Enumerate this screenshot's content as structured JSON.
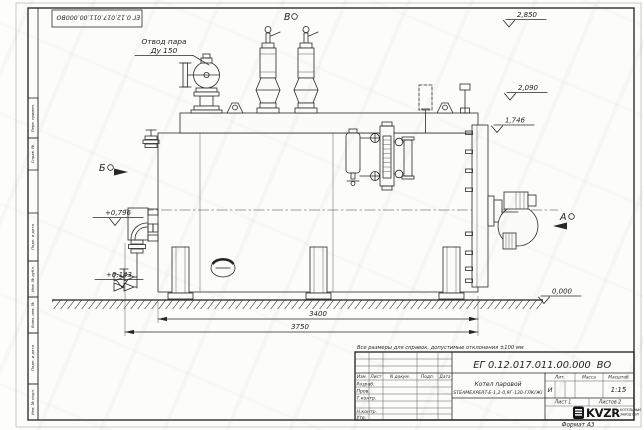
{
  "sheet": {
    "note": "Все размеры для справок, допустимые отклонения ±100 мм",
    "designation_number": "ЕГ 0.12.017.011.00.000",
    "designation_suffix": "ВО",
    "format_label": "Формат А3"
  },
  "side_stamps": [
    "Перв. примен.",
    "Справ. №",
    "Подп. и дата",
    "Инв. № дубл.",
    "Взам. инв. №",
    "Подп. и дата",
    "Инв. № подл."
  ],
  "title_block": {
    "columns": [
      "Изм.",
      "Лист",
      "N докум.",
      "Подп.",
      "Дата"
    ],
    "row_developed": "Разраб.",
    "row_checked": "Пров.",
    "row_tcontrol": "Т.контр.",
    "row_ncontrol": "Н.контр.",
    "row_approved": "Утв.",
    "product_title": "Котел паровой",
    "product_model": "STEAMEXPERT-Е-1,2-0,9Г-130-ГЛК(Ж)",
    "lit_label": "Лит.",
    "lit_value": "И",
    "mass_label": "Масса",
    "scale_label": "Масштаб",
    "scale_value": "1:15",
    "sheet_text": "Лист 1",
    "sheets_text": "Листов 2",
    "logo_text": "KVZR",
    "logo_sub1": "КОТЕЛЬНЫЙ",
    "logo_sub2": "ЗАВОД РЭП"
  },
  "annotations": {
    "steam_outlet_line1": "Отвод пара",
    "steam_outlet_line2": "Ду 150",
    "view_top": "В",
    "view_left": "Б",
    "view_right": "А",
    "elev_2850": "2,850",
    "elev_2090": "2,090",
    "elev_1746": "1,746",
    "elev_0000": "0,000",
    "elev_0796": "+0,796",
    "elev_0143": "+0,143",
    "dim_3400": "3400",
    "dim_3750": "3750"
  }
}
